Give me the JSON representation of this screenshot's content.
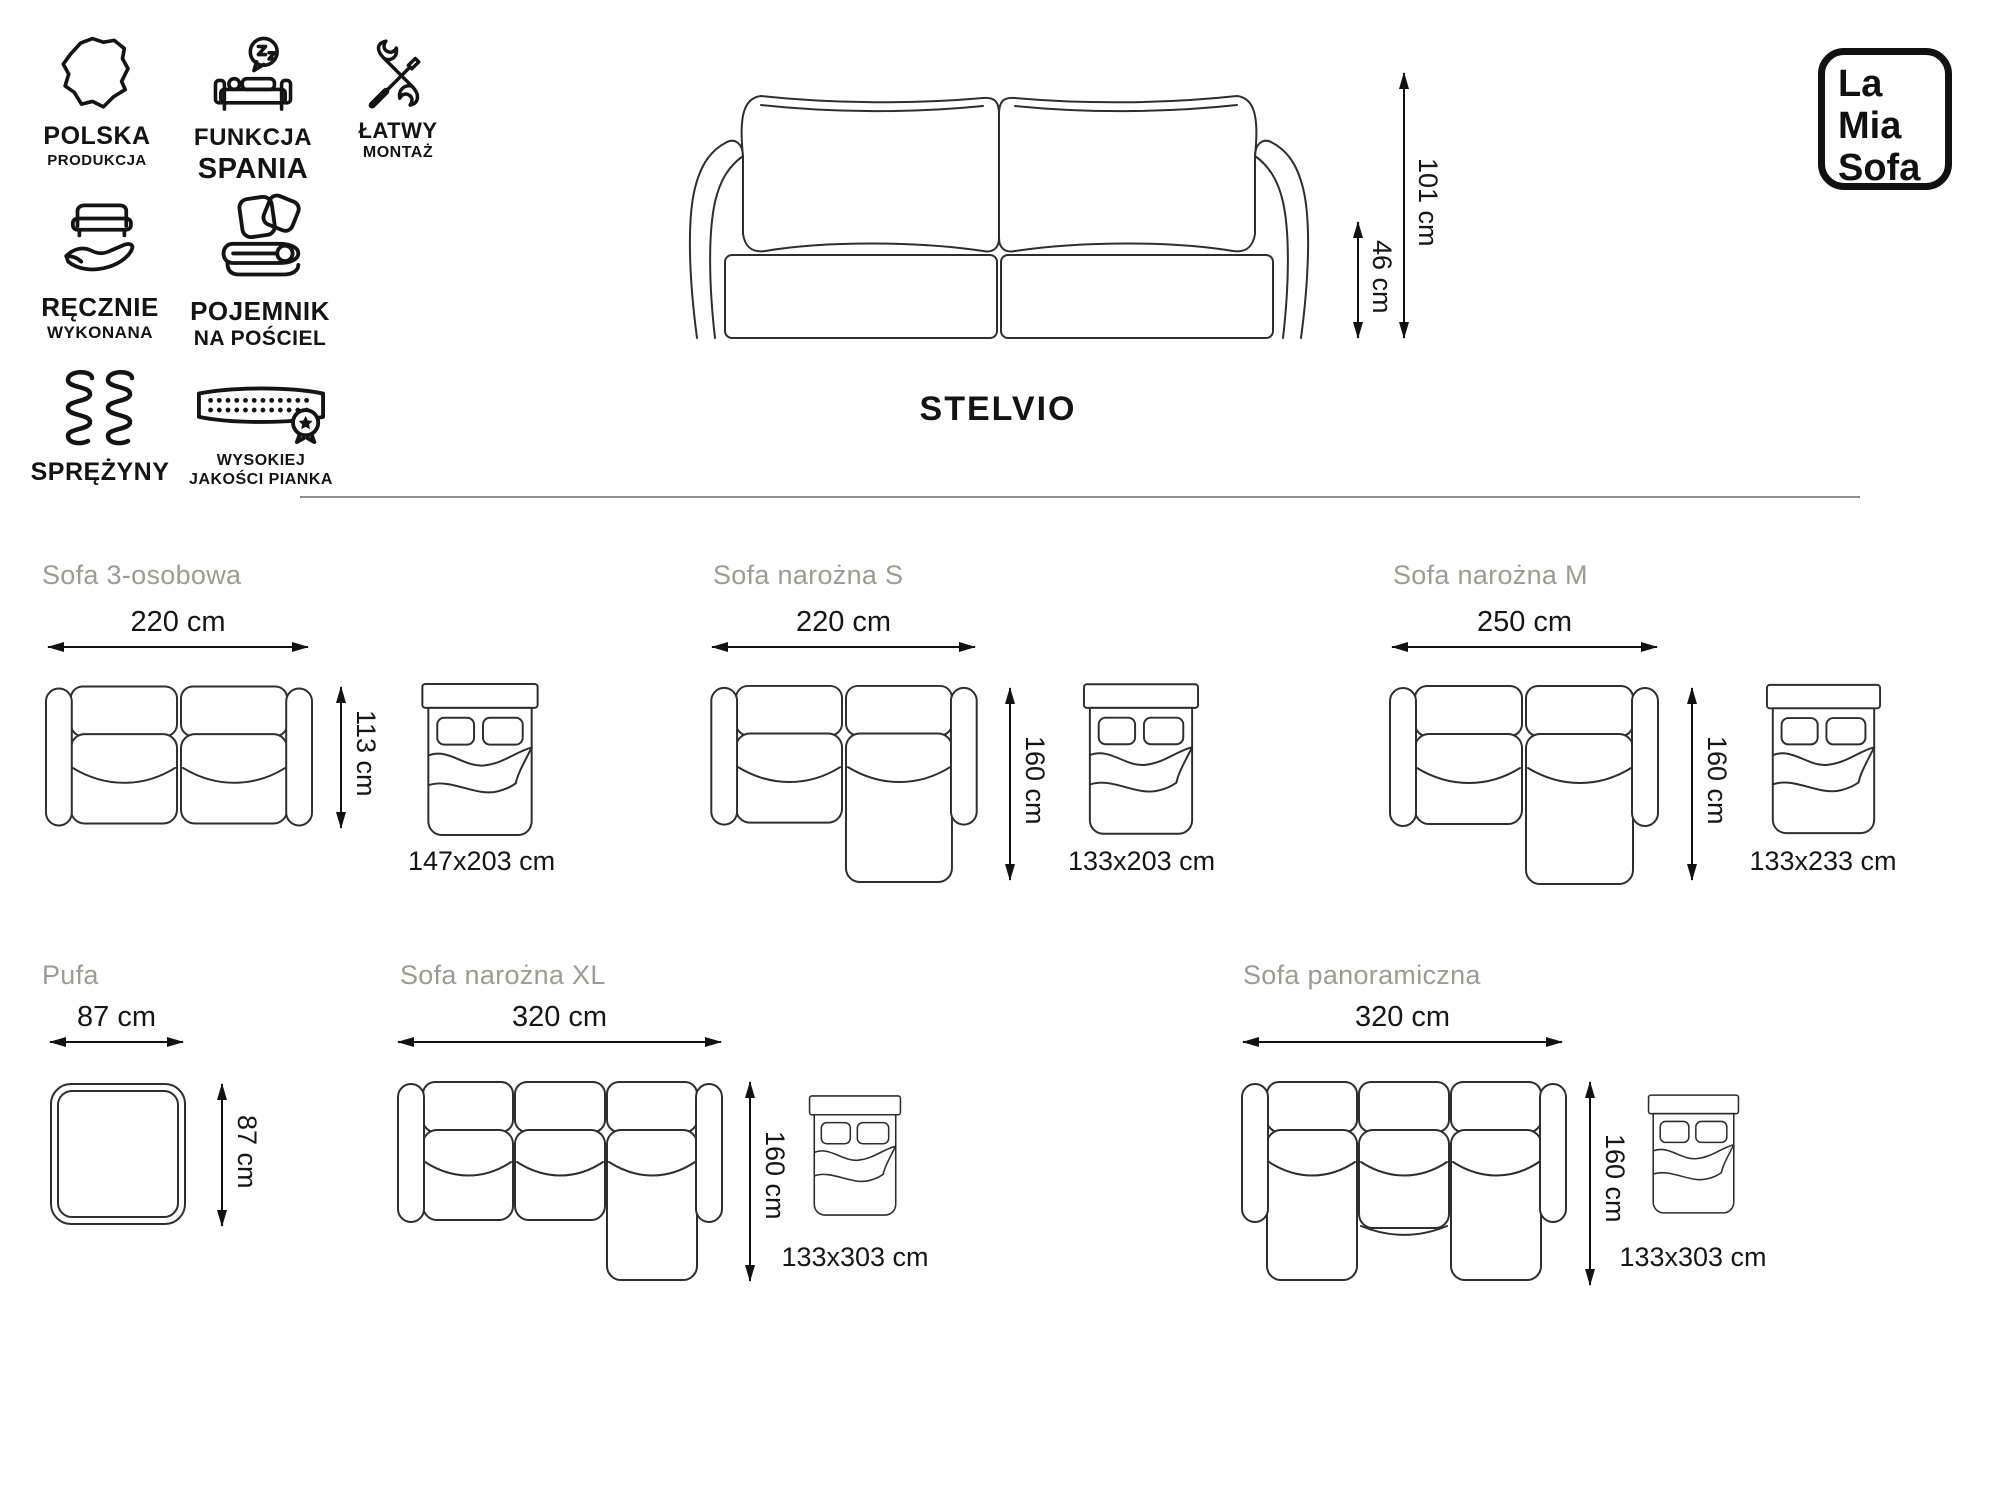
{
  "product": {
    "name": "STELVIO"
  },
  "logo": {
    "lines": [
      "La",
      "Mia",
      "Sofa"
    ]
  },
  "features": [
    {
      "icon": "poland-map-icon",
      "line1": "POLSKA",
      "line2": "PRODUKCJA"
    },
    {
      "icon": "sleep-function-icon",
      "line1": "FUNKCJA",
      "line2": "SPANIA"
    },
    {
      "icon": "easy-assembly-icon",
      "line1": "ŁATWY",
      "line2": "MONTAŻ"
    },
    {
      "icon": "handmade-icon",
      "line1": "RĘCZNIE",
      "line2": "WYKONANA"
    },
    {
      "icon": "bedding-storage-icon",
      "line1": "POJEMNIK",
      "line2": "NA POŚCIEL"
    },
    {
      "icon": "springs-icon",
      "line1": "SPRĘŻYNY",
      "line2": ""
    },
    {
      "icon": "quality-foam-icon",
      "line1": "WYSOKIEJ",
      "line2": "JAKOŚCI PIANKA"
    }
  ],
  "front_view": {
    "total_height": "101 cm",
    "seat_height": "46 cm"
  },
  "variants": [
    {
      "name": "Sofa 3-osobowa",
      "width": "220 cm",
      "depth": "113 cm",
      "bed_size": "147x203 cm"
    },
    {
      "name": "Sofa narożna S",
      "width": "220 cm",
      "depth": "160 cm",
      "bed_size": "133x203 cm"
    },
    {
      "name": "Sofa narożna M",
      "width": "250 cm",
      "depth": "160 cm",
      "bed_size": "133x233 cm"
    },
    {
      "name": "Pufa",
      "width": "87 cm",
      "depth": "87 cm"
    },
    {
      "name": "Sofa narożna XL",
      "width": "320 cm",
      "depth": "160 cm",
      "bed_size": "133x303 cm"
    },
    {
      "name": "Sofa panoramiczna",
      "width": "320 cm",
      "depth": "160 cm",
      "bed_size": "133x303 cm"
    }
  ],
  "colors": {
    "heading_gray": "#9c9c94",
    "line_art": "#2e2e2e",
    "dimension_text": "#161616",
    "divider": "#8f8f8f",
    "logo_border": "#111111"
  }
}
